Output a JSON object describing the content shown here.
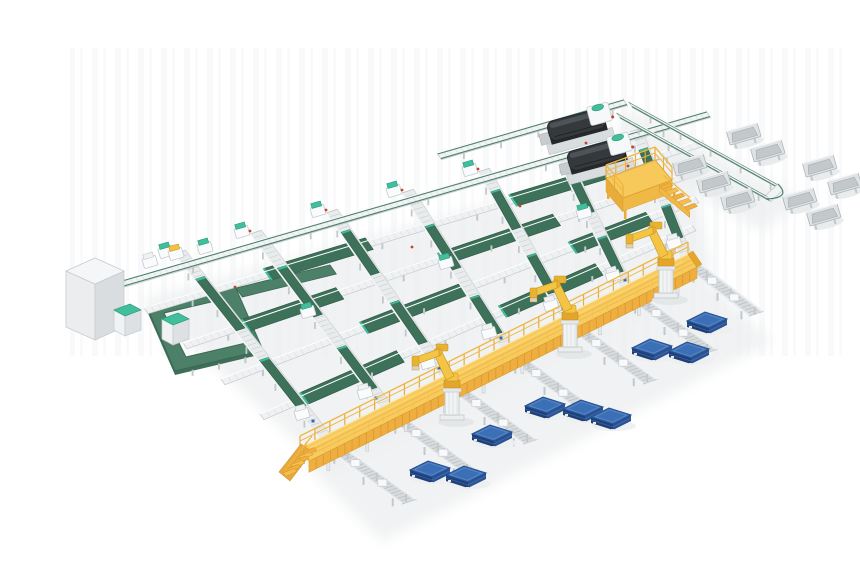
{
  "meta": {
    "title": "3D render of an automated conveyor sorting and robotic palletizing line"
  },
  "palette": {
    "bg": "#FFFFFF",
    "stripe1": "#F2F4F5",
    "stripe2": "#F5F6F7",
    "shadow": "#ECEEEF",
    "shadow2": "#E4E7E8",
    "laneBase": "#E9ECED",
    "laneEdge": "#BFC4C7",
    "roller": "#CDD2D4",
    "beltGreen": "#3E7159",
    "beltGreenDark": "#2F5A46",
    "beltGreenLight": "#4C8068",
    "teal": "#41BF9D",
    "tealDark": "#2E9A7D",
    "frame": "#F1F3F4",
    "frameEdge": "#C5CACD",
    "tick": "#DEE2E4",
    "spurFill": "#E4E7E9",
    "spurInner": "#D7DBDD",
    "spurEdge": "#B7BCBF",
    "leg": "#C3C8CB",
    "grayLight": "#DFE3E5",
    "grayMid": "#C3C8CB",
    "grayDark": "#AEB4B8",
    "white": "#F8F9FA",
    "walkTop": "#F8CB5F",
    "walkSide": "#EFAF40",
    "walkRib": "#DD9B33",
    "walkRail": "#F0B844",
    "walkPost": "#E9AC3A",
    "walkHi": "#FDEBB0",
    "stairA": "#F4BE4C",
    "stairB": "#EFB03C",
    "stairEdge": "#D3932B",
    "platDeck": "#F7C95B",
    "platSideL": "#E9AC3A",
    "platSideF": "#F0B845",
    "platEdge": "#D89F2E",
    "robotY": "#F4C545",
    "robotMid": "#E8B232",
    "robotDark": "#C6921C",
    "robotBase": "#E3A52C",
    "pedestal": "#F1F3F4",
    "pedestalEdge": "#C0C5C8",
    "palletTop": "#3B6FB6",
    "palletTopEdge": "#27508F",
    "palletInner": "#5E8AC8",
    "palletSideL": "#1F4077",
    "palletSideR": "#2A5292",
    "machineDark": "#35393C",
    "machineTop": "#4E5357",
    "machineUnder": "#26292C",
    "machineEdge": "#202427",
    "cubeTop": "#F5F6F7",
    "cubeLeft": "#EBEDEF",
    "cubeRight": "#DADDDF",
    "cubeEdge": "#C8CCCF",
    "loopGreen": "#4C8068",
    "loopEdge": "#3A6752",
    "loopHi": "#6FA78C",
    "loopSide": "#3F6E58",
    "red": "#C0452E",
    "blue": "#3A66B0",
    "yellowItem": "#F2C33F"
  },
  "scene": {
    "stripes": {
      "x": 70,
      "y": 48,
      "w": 780,
      "h": 308
    },
    "shadows": [
      {
        "pts": [
          [
            140,
            300
          ],
          [
            690,
            150
          ],
          [
            712,
            272
          ],
          [
            330,
            472
          ]
        ]
      },
      {
        "pts": [
          [
            302,
            462
          ],
          [
            700,
            272
          ],
          [
            772,
            342
          ],
          [
            382,
            542
          ]
        ]
      },
      {
        "pts": [
          [
            628,
            108
          ],
          [
            802,
            200
          ],
          [
            762,
            232
          ],
          [
            612,
            142
          ]
        ]
      }
    ],
    "topline": {
      "a": [
        118,
        281
      ],
      "b": [
        706,
        111
      ]
    },
    "feeder": {
      "a": [
        437,
        153
      ],
      "b": [
        623,
        99
      ]
    },
    "trayLines": [
      {
        "a": [
          628,
          101
        ],
        "b": [
          778,
          184
        ]
      },
      {
        "a": [
          616,
          112
        ],
        "b": [
          766,
          195
        ]
      }
    ],
    "lanes": [
      {
        "a": [
          174,
          254
        ],
        "b": [
          319,
          438
        ],
        "segs": [
          [
            0.14,
            0.42
          ],
          [
            0.58,
            0.84
          ]
        ]
      },
      {
        "a": [
          250,
          234
        ],
        "b": [
          380,
          408
        ],
        "segs": [
          [
            0.2,
            0.48
          ],
          [
            0.66,
            0.9
          ]
        ]
      },
      {
        "a": [
          326,
          213
        ],
        "b": [
          440,
          378
        ],
        "segs": [
          [
            0.12,
            0.38
          ],
          [
            0.55,
            0.8
          ]
        ]
      },
      {
        "a": [
          402,
          193
        ],
        "b": [
          500,
          348
        ],
        "segs": [
          [
            0.22,
            0.5
          ],
          [
            0.68,
            0.92
          ]
        ]
      },
      {
        "a": [
          478,
          172
        ],
        "b": [
          560,
          318
        ],
        "segs": [
          [
            0.14,
            0.4
          ],
          [
            0.58,
            0.84
          ]
        ]
      },
      {
        "a": [
          554,
          152
        ],
        "b": [
          620,
          288
        ],
        "segs": [
          [
            0.2,
            0.46
          ],
          [
            0.64,
            0.9
          ]
        ]
      },
      {
        "a": [
          630,
          132
        ],
        "b": [
          680,
          258
        ],
        "segs": [
          [
            0.15,
            0.42
          ],
          [
            0.6,
            0.86
          ]
        ]
      }
    ],
    "cross": [
      {
        "a": [
          144,
          308
        ],
        "b": [
          702,
          140
        ],
        "segs": [
          [
            0.22,
            0.4
          ],
          [
            0.66,
            0.82
          ]
        ]
      },
      {
        "a": [
          183,
          343
        ],
        "b": [
          699,
          168
        ],
        "segs": [
          [
            0.12,
            0.3
          ],
          [
            0.5,
            0.72
          ]
        ]
      },
      {
        "a": [
          221,
          379
        ],
        "b": [
          695,
          197
        ],
        "segs": [
          [
            0.3,
            0.52
          ],
          [
            0.74,
            0.9
          ]
        ]
      },
      {
        "a": [
          260,
          414
        ],
        "b": [
          692,
          225
        ],
        "segs": [
          [
            0.1,
            0.32
          ],
          [
            0.56,
            0.78
          ]
        ]
      }
    ],
    "loop": {
      "outer": [
        [
          147,
          307
        ],
        [
          235,
          286
        ],
        [
          263,
          350
        ],
        [
          175,
          371
        ]
      ],
      "inner": [
        [
          164,
          313
        ],
        [
          224,
          299
        ],
        [
          246,
          343
        ],
        [
          186,
          357
        ]
      ],
      "entry": {
        "a": [
          236,
          288
        ],
        "b": [
          330,
          265
        ]
      }
    },
    "walkway": {
      "a": [
        300,
        448
      ],
      "b": [
        688,
        254
      ]
    },
    "platform": {
      "deck": [
        [
          606,
          178
        ],
        [
          655,
          160
        ],
        [
          672,
          180
        ],
        [
          623,
          198
        ]
      ]
    },
    "machines": [
      [
        545,
        131
      ],
      [
        565,
        161
      ]
    ],
    "cube": {
      "top": [
        [
          66,
          271
        ],
        [
          95,
          258
        ],
        [
          124,
          271
        ],
        [
          95,
          284
        ]
      ],
      "left": [
        [
          66,
          271
        ],
        [
          95,
          284
        ],
        [
          95,
          340
        ],
        [
          66,
          327
        ]
      ],
      "right": [
        [
          95,
          284
        ],
        [
          124,
          271
        ],
        [
          124,
          327
        ],
        [
          95,
          340
        ]
      ]
    },
    "cabinets": [
      [
        114,
        304
      ],
      [
        162,
        313
      ]
    ],
    "spurs": [
      {
        "a": [
          325,
          448
        ],
        "b": [
          402,
          504
        ]
      },
      {
        "a": [
          386,
          418
        ],
        "b": [
          463,
          474
        ]
      },
      {
        "a": [
          446,
          388
        ],
        "b": [
          523,
          444
        ]
      },
      {
        "a": [
          506,
          358
        ],
        "b": [
          583,
          414
        ]
      },
      {
        "a": [
          566,
          328
        ],
        "b": [
          643,
          384
        ]
      },
      {
        "a": [
          626,
          298
        ],
        "b": [
          703,
          354
        ]
      },
      {
        "a": [
          686,
          268
        ],
        "b": [
          749,
          316
        ]
      }
    ],
    "robots": [
      [
        452,
        418
      ],
      [
        570,
        350
      ],
      [
        666,
        296
      ]
    ],
    "pallets": [
      [
        430,
        469
      ],
      [
        466,
        474
      ],
      [
        492,
        433
      ],
      [
        545,
        405
      ],
      [
        583,
        408
      ],
      [
        611,
        416
      ],
      [
        652,
        347
      ],
      [
        689,
        350
      ],
      [
        707,
        320
      ]
    ],
    "trays": {
      "right": [
        [
          744,
          135
        ],
        [
          768,
          152
        ],
        [
          820,
          167
        ],
        [
          845,
          185
        ]
      ],
      "left": [
        [
          690,
          166
        ],
        [
          714,
          183
        ],
        [
          738,
          200
        ],
        [
          800,
          200
        ],
        [
          824,
          216
        ]
      ]
    },
    "carriages": [
      [
        166,
        252,
        "t"
      ],
      [
        242,
        232,
        "t"
      ],
      [
        318,
        211,
        "t"
      ],
      [
        394,
        191,
        "t"
      ],
      [
        470,
        170,
        "t"
      ],
      [
        302,
        414,
        "w"
      ],
      [
        365,
        393,
        "w"
      ],
      [
        428,
        363,
        "w"
      ],
      [
        489,
        333,
        "w"
      ],
      [
        551,
        305,
        "w"
      ],
      [
        613,
        276,
        "w"
      ],
      [
        674,
        243,
        "w"
      ],
      [
        308,
        312,
        "t"
      ],
      [
        446,
        263,
        "t"
      ],
      [
        584,
        213,
        "t"
      ],
      [
        150,
        262,
        "w"
      ],
      [
        176,
        254,
        "y"
      ],
      [
        205,
        248,
        "t"
      ]
    ],
    "redDots": [
      [
        250,
        231
      ],
      [
        326,
        210
      ],
      [
        402,
        190
      ],
      [
        478,
        169
      ],
      [
        235,
        287
      ],
      [
        412,
        247
      ],
      [
        520,
        206
      ],
      [
        628,
        166
      ],
      [
        586,
        143
      ]
    ],
    "blueDots": [
      [
        313,
        421
      ],
      [
        376,
        398
      ],
      [
        439,
        368
      ],
      [
        501,
        338
      ],
      [
        563,
        309
      ],
      [
        625,
        280
      ]
    ]
  }
}
